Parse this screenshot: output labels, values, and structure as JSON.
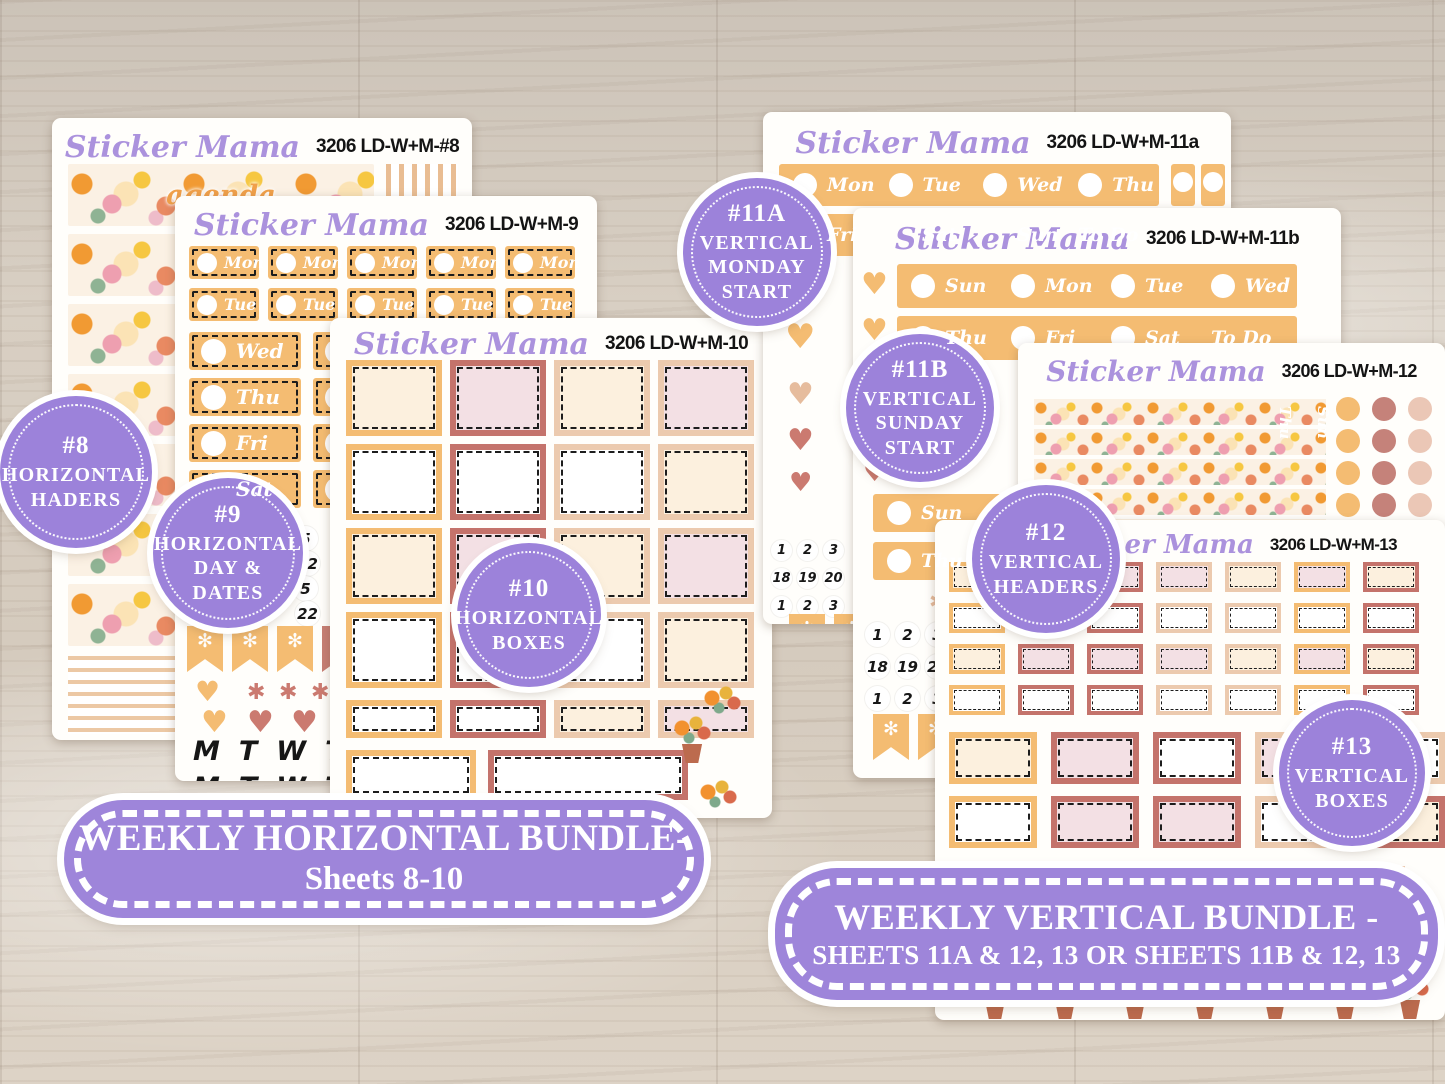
{
  "product": {
    "brand_script": "Sticker Mama"
  },
  "sheets": {
    "s8": {
      "code": "3206 LD-W+M-#8",
      "words": [
        "agenda",
        "to do"
      ]
    },
    "s9": {
      "code": "3206 LD-W+M-9"
    },
    "s10": {
      "code": "3206 LD-W+M-10"
    },
    "s11a": {
      "code": "3206 LD-W+M-11a"
    },
    "s11b": {
      "code": "3206 LD-W+M-11b"
    },
    "s12": {
      "code": "3206 LD-W+M-12"
    },
    "s13": {
      "code": "3206 LD-W+M-13"
    }
  },
  "days": {
    "mon": "Mon",
    "tue": "Tue",
    "wed": "Wed",
    "thu": "Thu",
    "fri": "Fri",
    "sat": "Sat",
    "sun": "Sun",
    "todo": "To Do"
  },
  "letters": {
    "m": "M",
    "t": "T",
    "w": "W",
    "f": "F"
  },
  "numbers": {
    "row1": [
      "1",
      "2",
      "3",
      "4",
      "5",
      "6"
    ],
    "row2": [
      "18",
      "19",
      "20",
      "21",
      "22",
      "23"
    ],
    "row3": [
      "1",
      "2",
      "3",
      "4",
      "5",
      "27"
    ]
  },
  "icons": {
    "heart": "♥",
    "flower": "✻",
    "asterisk": "✱"
  },
  "badges": {
    "b8": {
      "num": "#8",
      "l1": "HORIZONTAL",
      "l2": "HADERS"
    },
    "b9": {
      "num": "#9",
      "l1": "HORIZONTAL",
      "l2": "DAY &",
      "l3": "DATES"
    },
    "b10": {
      "num": "#10",
      "l1": "HORIZONTAL",
      "l2": "BOXES"
    },
    "b11a": {
      "num": "#11A",
      "l1": "VERTICAL",
      "l2": "MONDAY",
      "l3": "START"
    },
    "b11b": {
      "num": "#11B",
      "l1": "VERTICAL",
      "l2": "SUNDAY",
      "l3": "START"
    },
    "b12": {
      "num": "#12",
      "l1": "VERTICAL",
      "l2": "HEADERS"
    },
    "b13": {
      "num": "#13",
      "l1": "VERTICAL",
      "l2": "BOXES"
    }
  },
  "banners": {
    "horizontal": {
      "line1": "WEEKLY HORIZONTAL BUNDLE-",
      "line2": "Sheets 8-10"
    },
    "vertical": {
      "line1": "WEEKLY VERTICAL BUNDLE -",
      "line2": "SHEETS 11A & 12, 13 OR  SHEETS 11B & 12, 13"
    }
  },
  "colors": {
    "badge_purple": "#9c82da",
    "banner_purple": "#9e85da",
    "title_lavender": "#ab92dd",
    "orange": "#f4bc72",
    "rose": "#c9817a",
    "rose_frame": "#c4736b",
    "cream": "#fcf0de",
    "pink": "#f3e0e4",
    "peach": "#eccaae"
  }
}
